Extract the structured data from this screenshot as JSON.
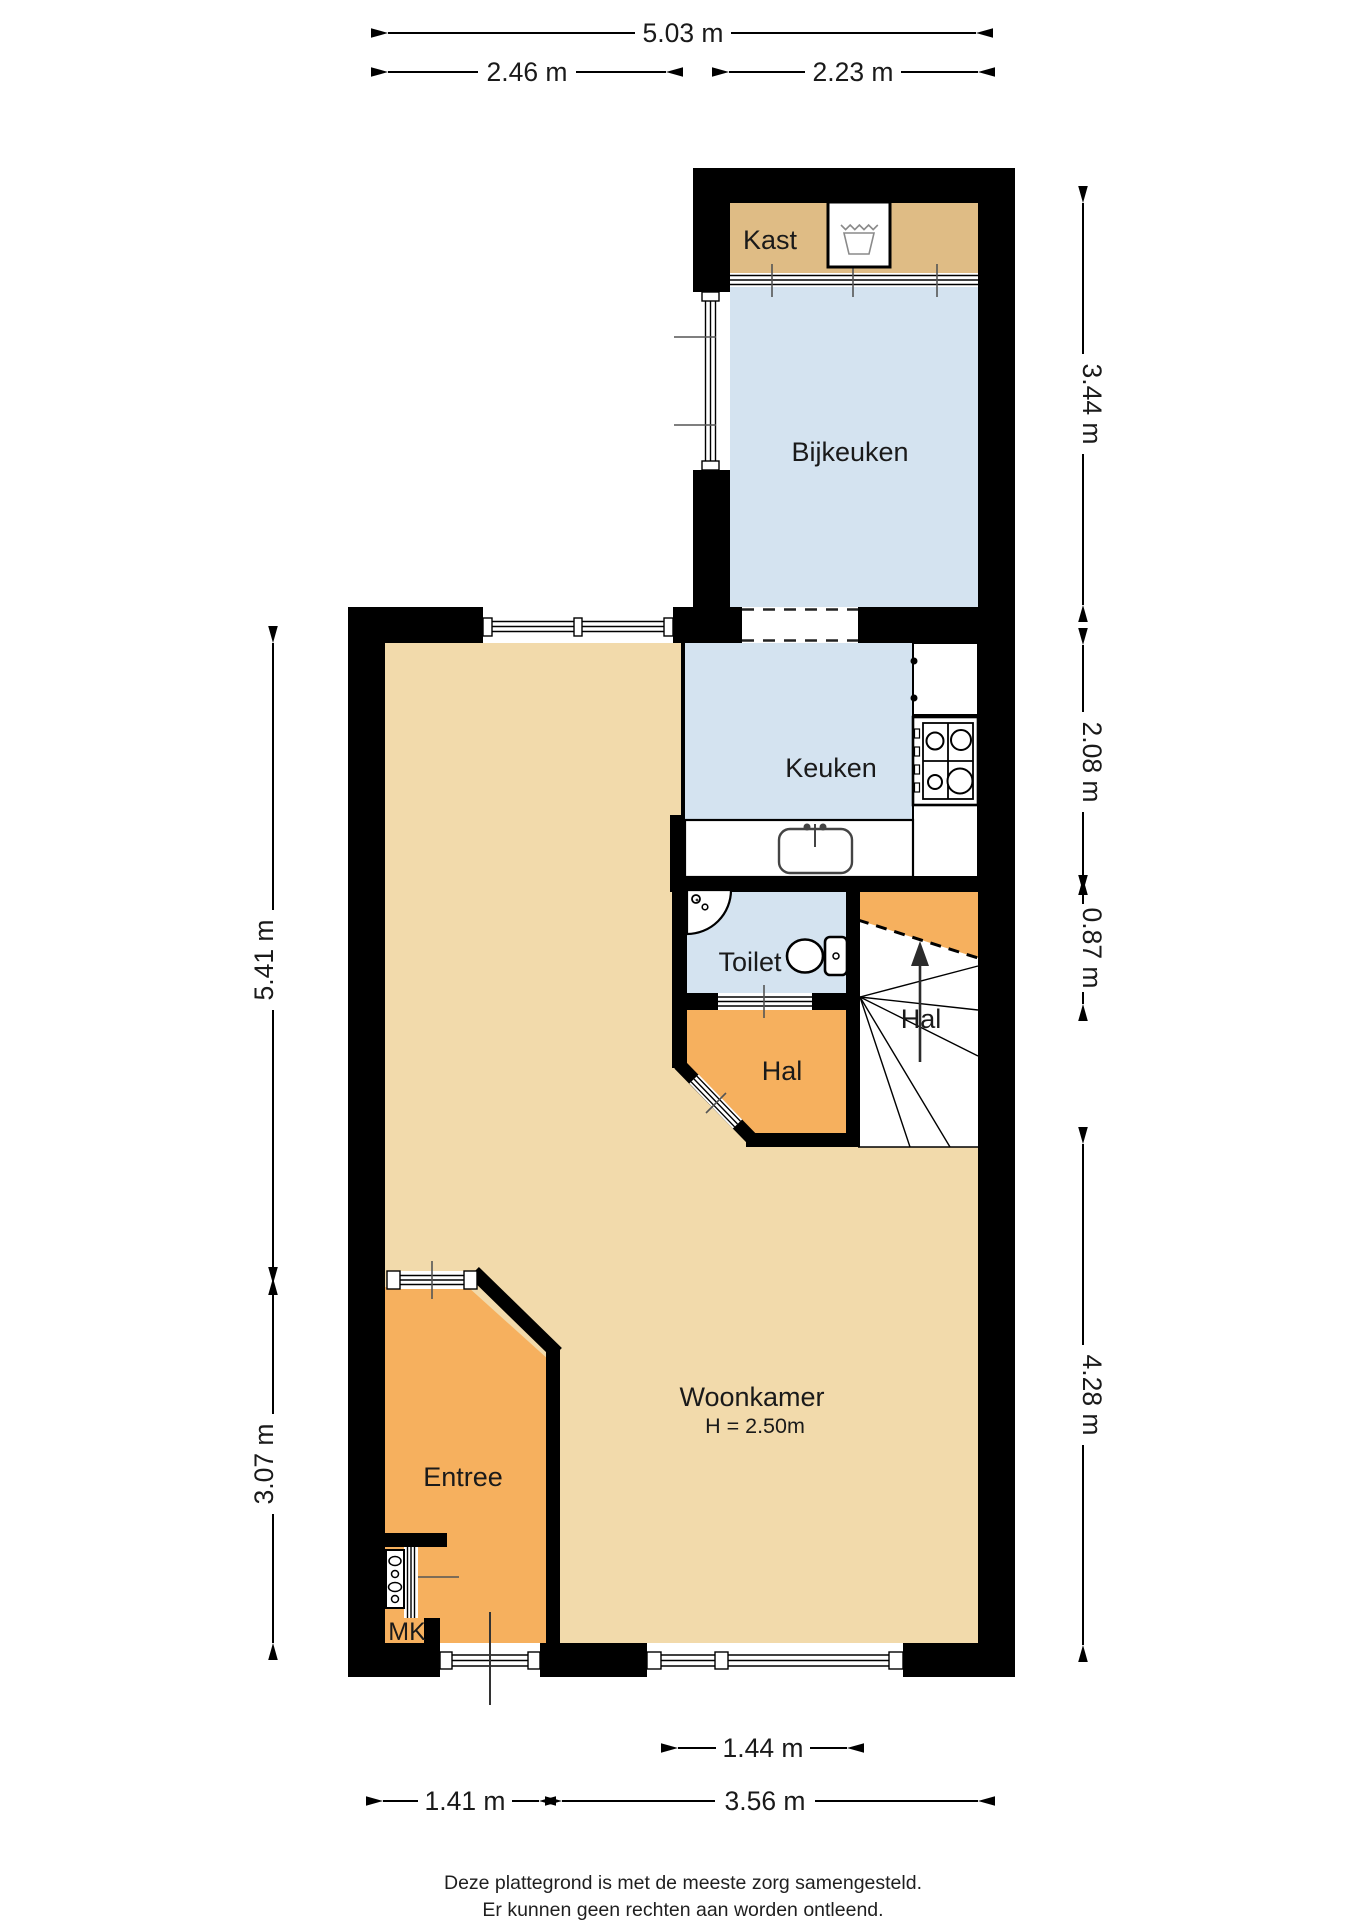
{
  "plan": {
    "rooms": {
      "kast": "Kast",
      "bijkeuken": "Bijkeuken",
      "keuken": "Keuken",
      "toilet": "Toilet",
      "hal_boven": "Hal",
      "hal_beneden": "Hal",
      "woonkamer": "Woonkamer",
      "woonkamer_hoogte": "H = 2.50m",
      "entree": "Entree",
      "mk": "MK"
    },
    "dimensions": {
      "top_total": "5.03 m",
      "top_left": "2.46 m",
      "top_right": "2.23 m",
      "right_bijkeuken": "3.44 m",
      "right_keuken": "2.08 m",
      "right_toilet": "0.87 m",
      "right_woonkamer": "4.28 m",
      "left_boven": "5.41 m",
      "left_onder": "3.07 m",
      "bottom_raam": "1.44 m",
      "bottom_entree": "1.41 m",
      "bottom_woonkamer": "3.56 m"
    },
    "footer": {
      "line1": "Deze plattegrond is met de meeste zorg samengesteld.",
      "line2": "Er kunnen geen rechten aan worden ontleend."
    },
    "colors": {
      "wall": "#000000",
      "floor_tan": "#F2DAAB",
      "floor_kast": "#DFBC85",
      "floor_orange": "#F6B05E",
      "floor_blue": "#D4E3F0",
      "white": "#FFFFFF"
    }
  }
}
